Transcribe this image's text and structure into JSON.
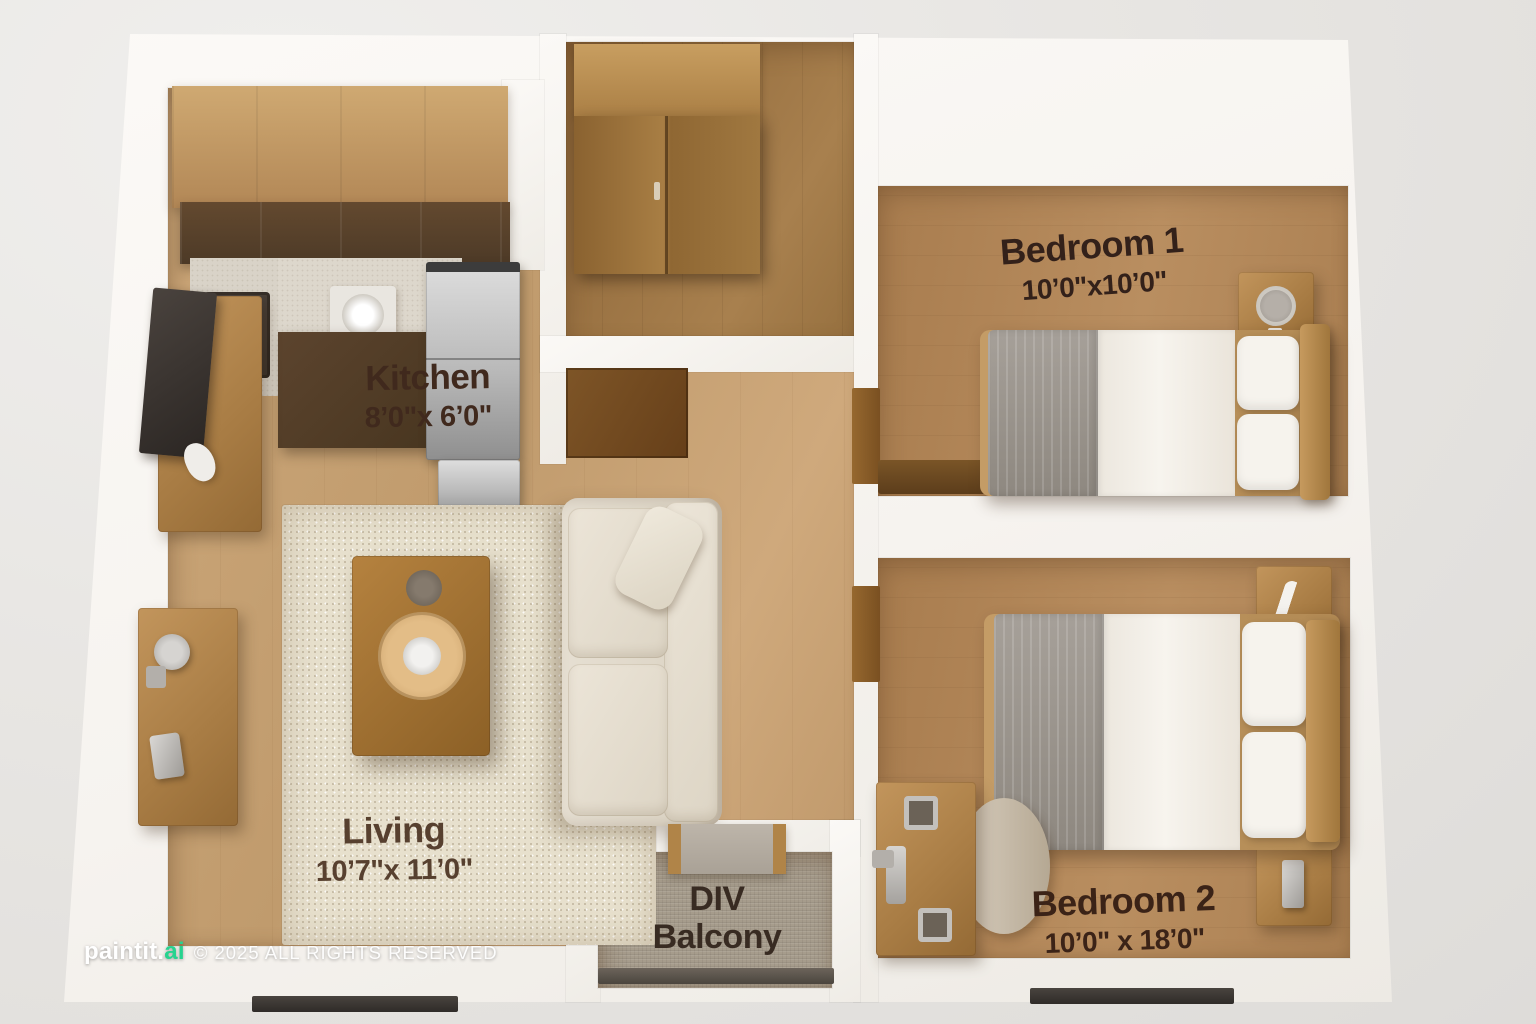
{
  "plan_title": "2 BHK apartment 3D floor plan",
  "rooms": {
    "kitchen": {
      "name": "Kitchen",
      "dimensions": "8’0\"x 6’0\""
    },
    "bedroom1": {
      "name": "Bedroom 1",
      "dimensions": "10’0\"x10’0\""
    },
    "living": {
      "name": "Living",
      "dimensions": "10’7\"x 11’0\""
    },
    "balcony": {
      "line1": "DIV",
      "line2": "Balcony"
    },
    "bedroom2": {
      "name": "Bedroom 2",
      "dimensions": "10’0\" x 18’0\""
    }
  },
  "watermark": {
    "brand": "paintit.",
    "accent": "ai",
    "copyright": "© 2025 ALL RIGHTS RESERVED",
    "accent_color": "#27d38f"
  },
  "palette": {
    "background": "#e8e6e3",
    "walls": "#f9f7f3",
    "wood_floor_light": "#c5a072",
    "wood_floor_dark": "#b0855a",
    "closet_floor": "#9a7343",
    "balcony_floor": "#a69c8c",
    "rug": "#e7e0cd",
    "sofa": "#e0d8ca",
    "wood_furniture": "#a87c44",
    "label_text": "#3f2a1e"
  }
}
